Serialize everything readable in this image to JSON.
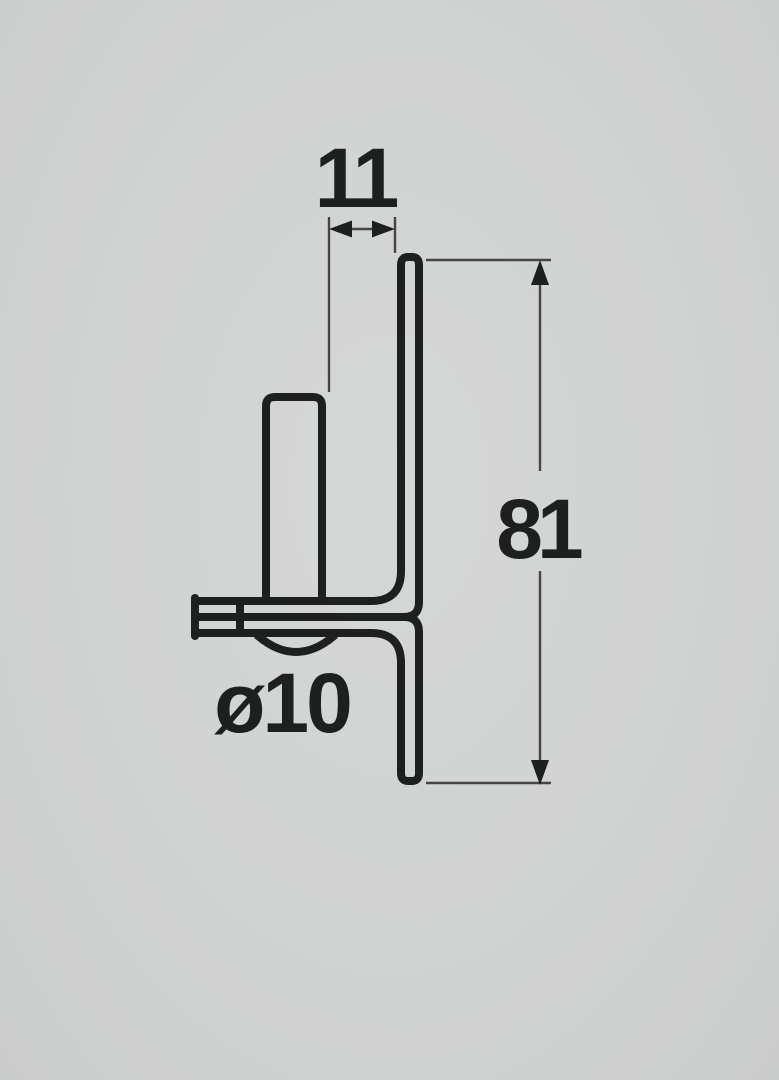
{
  "diagram": {
    "description": "Side-view technical drawing of a screw-on gate hinge pin bracket (L-plate with welded pin)",
    "labels": {
      "pin_offset": "11",
      "plate_height": "81",
      "pin_diameter": "ø10"
    },
    "colors": {
      "background": "#d1d2d2",
      "outline": "#1e1f1f",
      "dimension_line": "#454545"
    }
  }
}
